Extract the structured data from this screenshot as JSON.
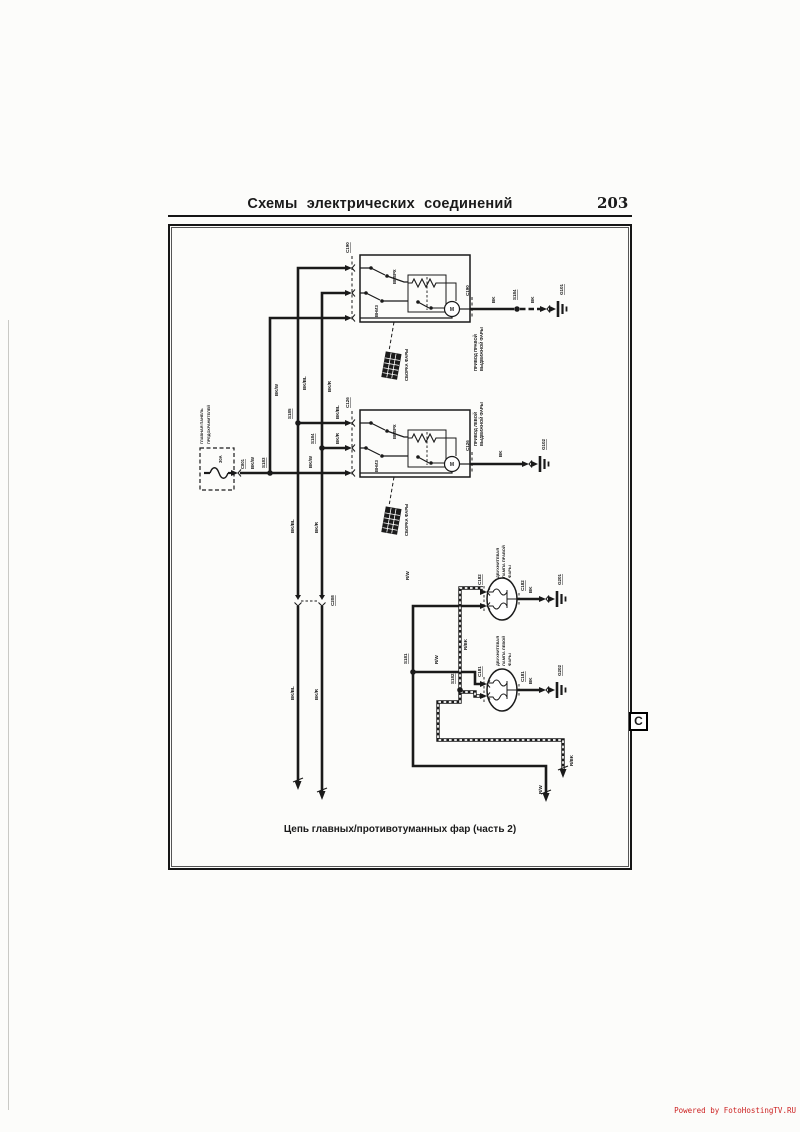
{
  "page": {
    "header": {
      "title": "Схемы электрических соединений",
      "page_number": "203"
    },
    "caption": "Цепь главных/противотуманных фар (часть 2)",
    "side_tab": "C",
    "watermark": "Powered by FotoHostingTV.RU",
    "ink_color": "#1a1a1a",
    "watermark_color": "#cc2222"
  },
  "diagram": {
    "fuse_panel": {
      "name_line1": "ГЛАВНАЯ ПАНЕЛЬ",
      "name_line2": "ПРЕДОХРАНИТЕЛЕЙ",
      "fuse_rating": "30A",
      "connector": "C801"
    },
    "right_retractor": {
      "name_line1": "ПРИВОД ПРАВОЙ",
      "name_line2": "ВЫДВИЖНОЙ ФАРЫ",
      "connector": "C190",
      "up": "ВВЕРХ",
      "down": "ВНИЗ",
      "motor": "М",
      "assembly": "СБОРКА ФАРЫ",
      "splice": "S184",
      "ground": "G101"
    },
    "left_retractor": {
      "name_line1": "ПРИВОД ЛЕВОЙ",
      "name_line2": "ВЫДВИЖНОЙ ФАРЫ",
      "connector": "C126",
      "up": "ВВЕРХ",
      "down": "ВНИЗ",
      "motor": "М",
      "assembly": "СБОРКА ФАРЫ",
      "ground": "G102"
    },
    "right_lamp": {
      "name_line1": "ДВУХНИТЕВАЯ",
      "name_line2": "ЛАМПА ПРАВОЙ",
      "name_line3": "ФАРЫ",
      "connector": "C182",
      "ground": "G201"
    },
    "left_lamp": {
      "name_line1": "ДВУХНИТЕВАЯ",
      "name_line2": "ЛАМПА ЛЕВОЙ",
      "name_line3": "ФАРЫ",
      "connector": "C181",
      "ground": "G202"
    },
    "splices": {
      "s181": "S181",
      "s182": "S182",
      "s183": "S183",
      "s184": "S184",
      "s185": "S185"
    },
    "inline_connector": "C208",
    "wires": {
      "bk": "BK",
      "bk_w": "BK/W",
      "bk_bl": "BK/BL",
      "bk_r": "BK/R",
      "r_w": "R/W",
      "r_bk": "R/BK"
    }
  }
}
